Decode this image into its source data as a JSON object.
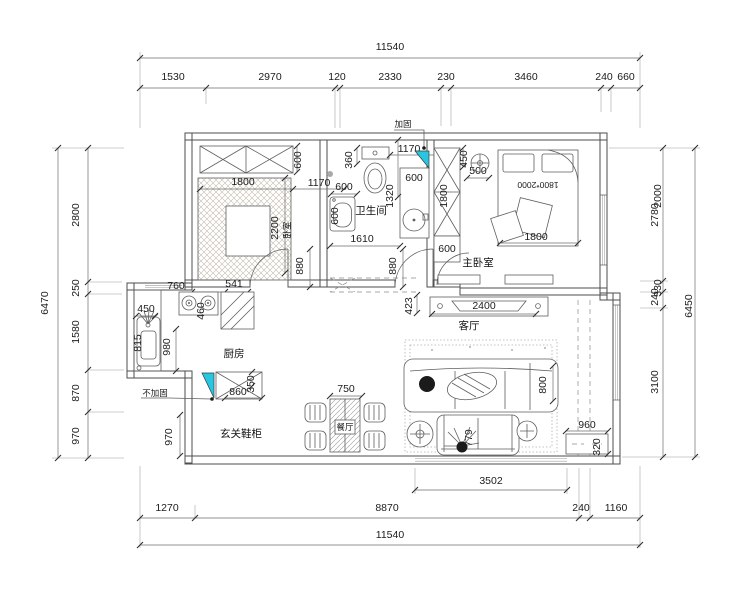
{
  "colors": {
    "accent": "#27c7e2",
    "wall_line": "#4d4d4d",
    "dim_line": "#6f6f6f",
    "text": "#1c1c1c"
  },
  "dims": {
    "top_total": "11540",
    "top": [
      "1530",
      "2970",
      "120",
      "2330",
      "230",
      "3460",
      "240",
      "660"
    ],
    "left_total": "6470",
    "left": [
      "2800",
      "250",
      "1580",
      "870",
      "970"
    ],
    "right_total": "6450",
    "right": [
      "2780",
      "2000",
      "240",
      "330",
      "3100"
    ],
    "bottom_total": "11540",
    "bottom": [
      "1270",
      "8870",
      "240",
      "1160"
    ],
    "bottom_inner": "3502"
  },
  "rooms": {
    "bedroom2": "卧室",
    "bathroom": "卫生间",
    "master_bedroom": "主卧室",
    "living": "客厅",
    "kitchen": "厨房",
    "dining": "餐厅",
    "entry_cabinet": "玄关鞋柜"
  },
  "notes": {
    "reinforce": "加固",
    "no_reinforce": "不加固",
    "bed_size": "1800*2000"
  },
  "inner_dims": {
    "bed2_w": "1800",
    "bed2_ward_d": "600",
    "bed2_1170": "1170",
    "bed2_l": "2200",
    "bed2_door": "880",
    "bed2_760": "760",
    "bed2_541": "541",
    "bath_360": "360",
    "bath_top": "1170",
    "bath_wash_w": "600",
    "bath_wash_d": "600",
    "bath_vanity": "600",
    "bath_1320": "1320",
    "bath_w": "1610",
    "bath_door": "880",
    "hall_450": "450",
    "hall_500": "500",
    "hall_ward": "1800",
    "hall_ward_d": "600",
    "master_bed_w": "1800",
    "living_423": "423",
    "living_tv": "2400",
    "living_sofa": "800",
    "living_love": "779",
    "kit_450": "450",
    "kit_815": "815",
    "kit_980": "980",
    "kit_460": "460",
    "kit_760": "760",
    "kit_541": "541",
    "entry_860": "860",
    "entry_350": "350",
    "entry_970": "970",
    "dining_750": "750",
    "balc_960": "960",
    "balc_320": "320"
  }
}
